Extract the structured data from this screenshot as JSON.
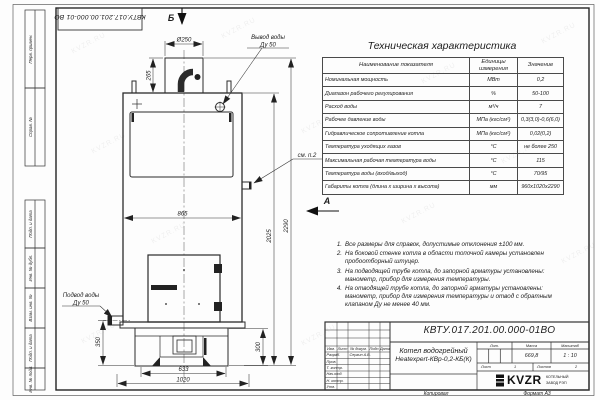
{
  "watermark": {
    "text": "KVZR.RU"
  },
  "stamp_corner": {
    "number": "КВТУ.017.201.00.000-01 ВО"
  },
  "margin_blocks": {
    "b1": "Перв. примен.",
    "b2": "Справ. №",
    "b3": "Подп. и дата",
    "b4": "Инв. № дубл.",
    "b5": "Взам. инв. №",
    "b6": "Подп. и дата",
    "b7": "Инв. № подл."
  },
  "views": {
    "section": "Б",
    "view": "А",
    "see_note": "см. п.2"
  },
  "callouts": {
    "outlet": {
      "line1": "Вывод воды",
      "line2": "Ду 50"
    },
    "inlet": {
      "line1": "Подвод воды",
      "line2": "Ду 50"
    }
  },
  "dims": {
    "chimney_dia": "Ø250",
    "chimney_h": "265",
    "body_w": "865",
    "body_h": "2025",
    "total_h": "2290",
    "inlet_h": "350",
    "base_h": "300",
    "base_w": "633",
    "total_w": "1020"
  },
  "spec_table": {
    "title": "Техническая характеристика",
    "col1": "Наименование показателя",
    "col2": "Единицы измерения",
    "col3": "Значение",
    "rows": [
      {
        "name": "Номинальная мощность",
        "unit": "МВт",
        "value": "0,2"
      },
      {
        "name": "Диапазон рабочего регулирования",
        "unit": "%",
        "value": "50-100"
      },
      {
        "name": "Расход воды",
        "unit": "м³/ч",
        "value": "7"
      },
      {
        "name": "Рабочее давление воды",
        "unit": "МПа (кгс/см²)",
        "value": "0,3(3,0)-0,6(6,0)"
      },
      {
        "name": "Гидравлическое сопротивление котла",
        "unit": "МПа (кгс/см²)",
        "value": "0,02(0,2)"
      },
      {
        "name": "Температура уходящих газов",
        "unit": "°С",
        "value": "не более 250"
      },
      {
        "name": "Максимальная рабочая температура воды",
        "unit": "°С",
        "value": "115"
      },
      {
        "name": "Температура воды (вход/выход)",
        "unit": "°С",
        "value": "70/95"
      },
      {
        "name": "Габариты котла (длина х ширина х высота)",
        "unit": "мм",
        "value": "960х1020х2290"
      }
    ]
  },
  "notes": {
    "items": [
      {
        "num": "1.",
        "text": "Все размеры для справок, допустимые отклонения ±100 мм."
      },
      {
        "num": "2.",
        "text": "На боковой стенке котла в области топочной камеры установлен пробоотборный штуцер."
      },
      {
        "num": "3.",
        "text": "На подводящей трубе котла, до запорной арматуры установлены: манометр, прибор для измерения температуры."
      },
      {
        "num": "4.",
        "text": "На отводящей трубе котла, до запорной арматуры установлены: манометр, прибор для измерения температуры и отвод с обратным клапаном Ду не менее 40 мм."
      }
    ]
  },
  "title_block": {
    "number": "КВТУ.017.201.00.000-01ВО",
    "name_line1": "Котел водогрейный",
    "name_line2": "Heatexpert-КВр-0,2-КБ(К)",
    "col_izm": "Изм.",
    "col_list": "Лист",
    "col_doc": "№ докум.",
    "col_podp": "Подп.",
    "col_data": "Дата",
    "row1_label": "Разраб.",
    "row1_value": "Сергин А.В.",
    "row2_label": "Пров.",
    "row3_label": "Т. контр.",
    "row4_label": "Нач.отд.",
    "row5_label": "Н. контр.",
    "row6_label": "Утв.",
    "lit_label": "Лит.",
    "mass_label": "Масса",
    "scale_label": "Масштаб",
    "mass_value": "669,8",
    "scale_value": "1 : 10",
    "sheet_label": "Лист",
    "sheet_value": "1",
    "sheets_label": "Листов",
    "sheets_value": "2",
    "logo_text": "KVZR",
    "logo_sub1": "КОТЕЛЬНЫЙ",
    "logo_sub2": "ЗАВОД РЭП"
  },
  "footer": {
    "copy": "Копировал",
    "format": "Формат А3"
  }
}
